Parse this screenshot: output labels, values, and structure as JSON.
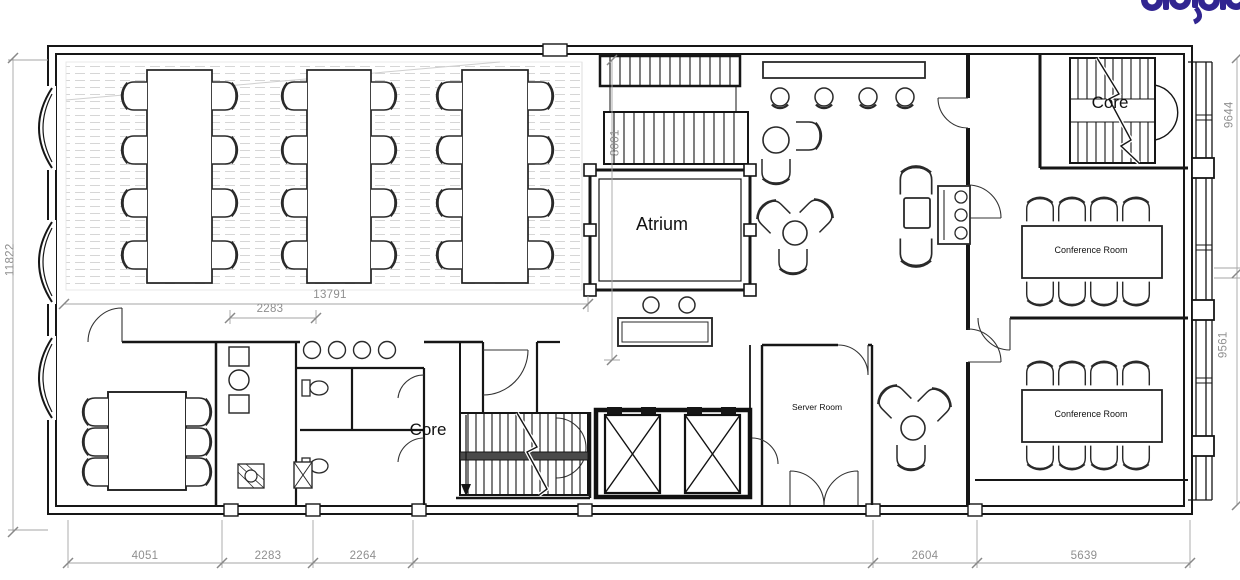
{
  "plan": {
    "title": "Office Floor Plan",
    "labels": {
      "atrium": "Atrium",
      "core_upper": "Core",
      "core_lower": "Core",
      "conference_room_1": "Conference Room",
      "conference_room_2": "Conference Room",
      "server_room": "Server Room"
    },
    "dimensions": {
      "left_height": "11822",
      "office_width": "13791",
      "wc_offset": "2283",
      "atrium_height": "8001",
      "bottom_1": "4051",
      "bottom_2": "2283",
      "bottom_3": "2264",
      "bottom_4": "2604",
      "bottom_5": "5639",
      "right_top": "9644",
      "right_bottom": "9561"
    },
    "colors": {
      "wall": "#161616",
      "furniture": "#2a2a2a",
      "dimension_line": "#a6a6a6",
      "dimension_text": "#8f8f8f",
      "hatch": "#d6d6d6",
      "logo": "#312591"
    }
  }
}
